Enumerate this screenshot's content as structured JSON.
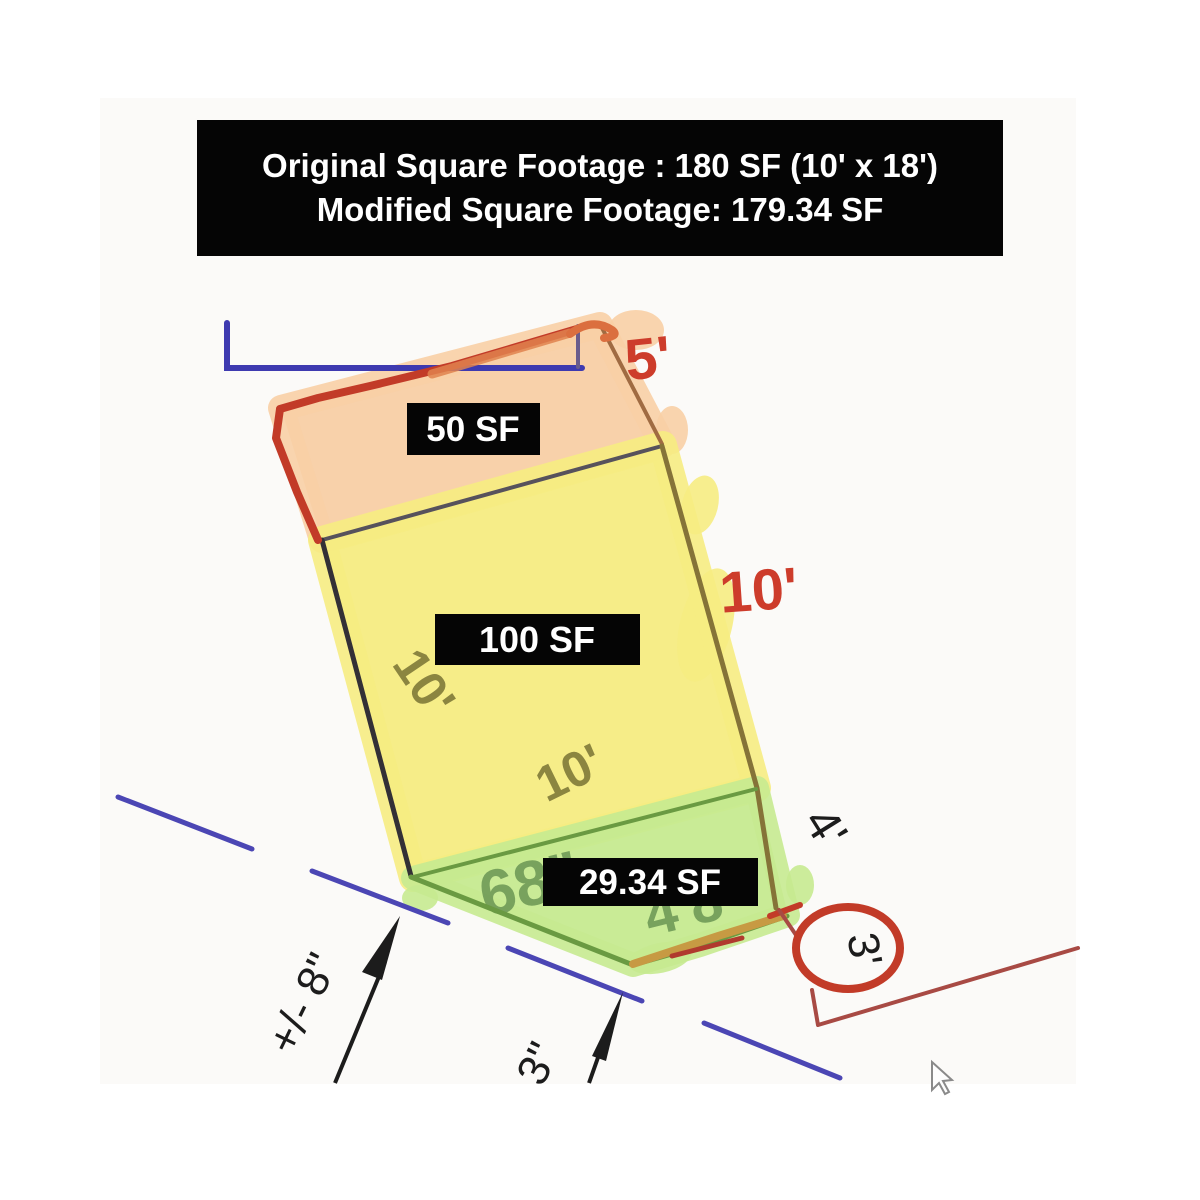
{
  "banner": {
    "line1": "Original Square Footage : 180 SF (10' x 18')",
    "line2": "Modified Square Footage: 179.34 SF"
  },
  "area_labels": {
    "strip": "50 SF",
    "main": "100 SF",
    "wedge": "29.34 SF"
  },
  "dimensions": {
    "strip_width_red": "5'",
    "main_side_red": "10'",
    "main_left": "10'",
    "main_bottom": "10'",
    "wedge_right": "4'",
    "corner_circled": "3'",
    "offset_left": "+/- 8\"",
    "offset_mid": "3\"",
    "underlying_left": "68\"",
    "underlying_right": "4'8"
  },
  "colors": {
    "highlight_orange": "#f8cfa5",
    "highlight_yellow": "#f6ec82",
    "highlight_green": "#c6ea90",
    "sketch_red": "#c23b28",
    "annotation_red": "#cd3c2b",
    "line_blue": "#4b46b4",
    "olive_text": "#8b8540",
    "label_bg": "#050505",
    "label_text": "#ffffff"
  }
}
